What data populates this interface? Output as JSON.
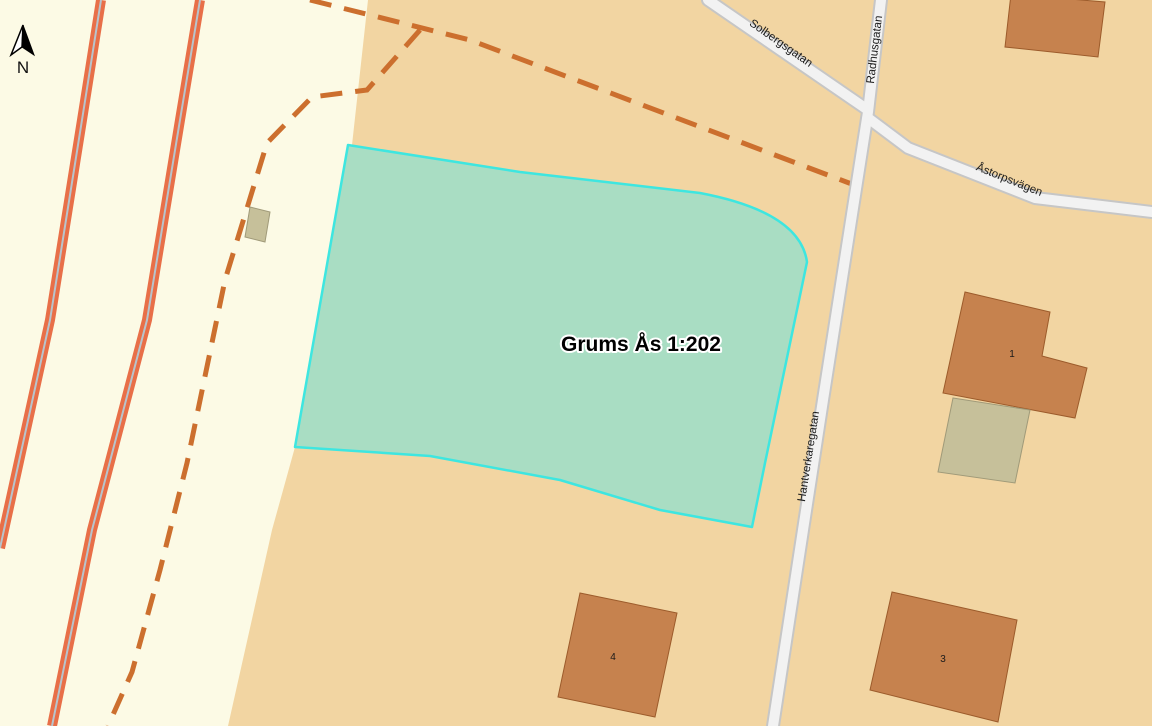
{
  "map": {
    "description": "Cadastral map view of a highlighted property parcel",
    "parcel": {
      "label": "Grums Ås 1:202"
    },
    "streets": [
      {
        "name": "Solbergsgatan"
      },
      {
        "name": "Radhusgatan"
      },
      {
        "name": "Åstorpsvägen"
      },
      {
        "name": "Hantverkaregatan"
      }
    ],
    "buildings": [
      {
        "number": "1"
      },
      {
        "number": "4"
      },
      {
        "number": "3"
      }
    ],
    "north_arrow": {
      "label": "N"
    },
    "colors": {
      "background_tan": "#F2D5A2",
      "background_cream": "#FCFAE5",
      "parcel_fill": "#A9DDC3",
      "parcel_border": "#3EE6E0",
      "building_fill": "#C6824E",
      "building_border": "#9C5B2B",
      "outbuilding_fill": "#C6C09A",
      "road_fill": "#F2F2F2",
      "road_casing": "#C6C6C6",
      "major_road_orange": "#E86F48",
      "major_road_centerline": "#B8C4CC",
      "boundary_dash": "#CC6F2E"
    }
  }
}
